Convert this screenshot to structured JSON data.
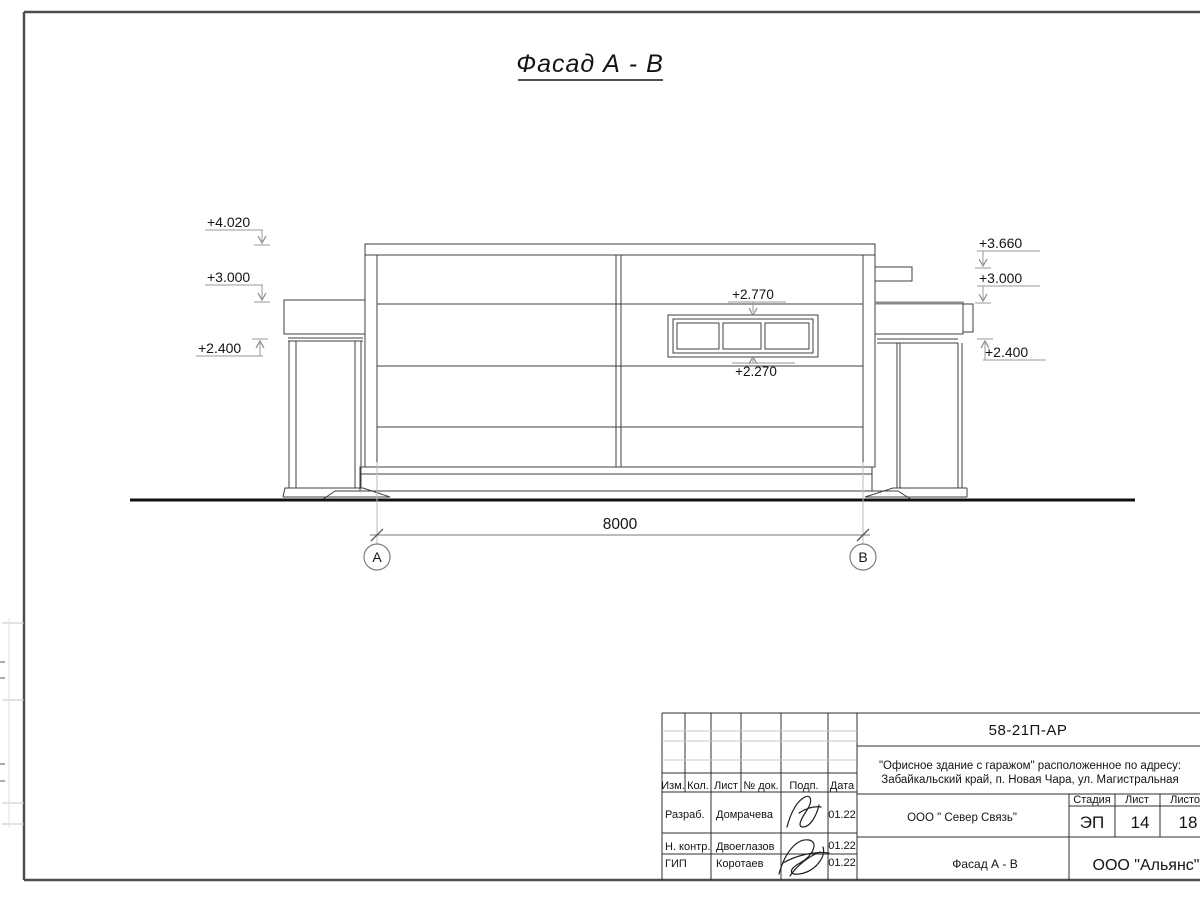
{
  "sheet": {
    "title": "Фасад А - В"
  },
  "drawing": {
    "marks": {
      "left_top": "+4.020",
      "left_mid": "+3.000",
      "left_low": "+2.400",
      "right_top": "+3.660",
      "right_mid": "+3.000",
      "right_low": "+2.400",
      "window_top": "+2.770",
      "window_bottom": "+2.270"
    },
    "dimension_value": "8000",
    "axis_a": "А",
    "axis_b": "В"
  },
  "title_block": {
    "doc_code": "58-21П-АР",
    "project_line1": "\"Офисное здание с гаражом\" расположенное по адресу:",
    "project_line2": "Забайкальский край, п. Новая Чара, ул. Магистральная",
    "header_cols": {
      "izm": "Изм.",
      "kol": "Кол.",
      "list": "Лист",
      "doc": "№ док.",
      "podp": "Подп.",
      "data": "Дата"
    },
    "rows": [
      {
        "role": "Разраб.",
        "name": "Домрачева",
        "date": "01.22"
      },
      {
        "role": "Н. контр.",
        "name": "Двоеглазов",
        "date": "01.22"
      },
      {
        "role": "ГИП",
        "name": "Коротаев",
        "date": "01.22"
      }
    ],
    "contractor": "ООО \" Север Связь\"",
    "stage_label": "Стадия",
    "sheet_label": "Лист",
    "sheets_label": "Листов",
    "stage_value": "ЭП",
    "sheet_value": "14",
    "sheets_value": "18",
    "sheet_name": "Фасад А - В",
    "org_name": "ООО \"Альянс\""
  },
  "colors": {
    "line": "#3f3f3f",
    "frame": "#4d4d4d",
    "leader": "#9a9a9a",
    "ground": "#111111"
  }
}
